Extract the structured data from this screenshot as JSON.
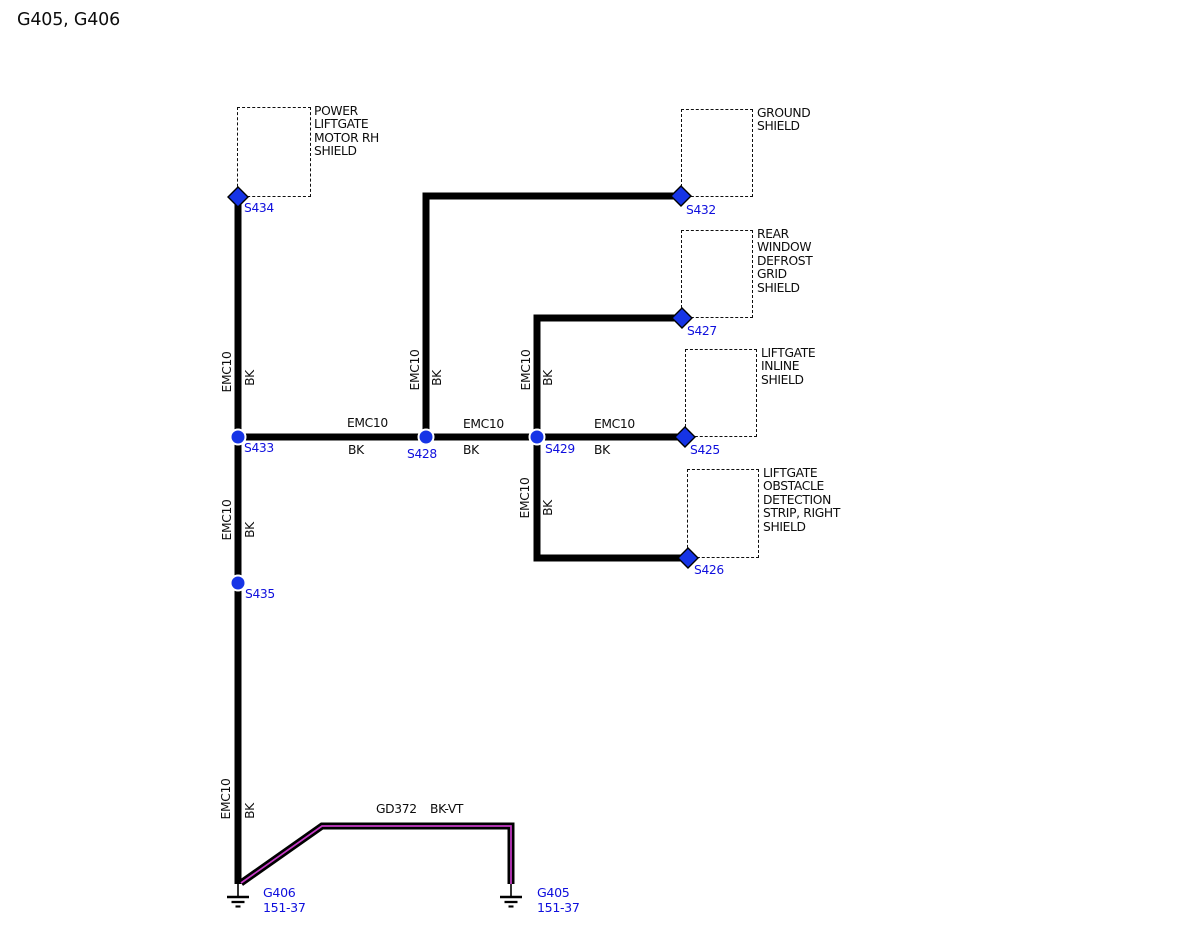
{
  "title": "G405, G406",
  "labels": {
    "emc10": "EMC10",
    "bk": "BK"
  },
  "ground_wire": {
    "circuit": "GD372",
    "color_code": "BK-VT"
  },
  "shields": {
    "power_liftgate": {
      "lines": [
        "POWER",
        "LIFTGATE",
        "MOTOR RH",
        "SHIELD"
      ]
    },
    "ground": {
      "lines": [
        "GROUND",
        "SHIELD"
      ]
    },
    "rear_window": {
      "lines": [
        "REAR",
        "WINDOW",
        "DEFROST",
        "GRID",
        "SHIELD"
      ]
    },
    "liftgate_inline": {
      "lines": [
        "LIFTGATE",
        "INLINE",
        "SHIELD"
      ]
    },
    "liftgate_obstacle": {
      "lines": [
        "LIFTGATE",
        "OBSTACLE",
        "DETECTION",
        "STRIP, RIGHT",
        "SHIELD"
      ]
    }
  },
  "splices": {
    "s434": "S434",
    "s432": "S432",
    "s427": "S427",
    "s425": "S425",
    "s426": "S426",
    "s433": "S433",
    "s428": "S428",
    "s429": "S429",
    "s435": "S435"
  },
  "grounds": {
    "g406": {
      "name": "G406",
      "ref": "151-37"
    },
    "g405": {
      "name": "G405",
      "ref": "151-37"
    }
  },
  "colors": {
    "wire_black": "#000000",
    "splice_blue": "#1634e6",
    "label_blue": "#0f0fdd",
    "violet_stripe": "#c73bc7"
  }
}
